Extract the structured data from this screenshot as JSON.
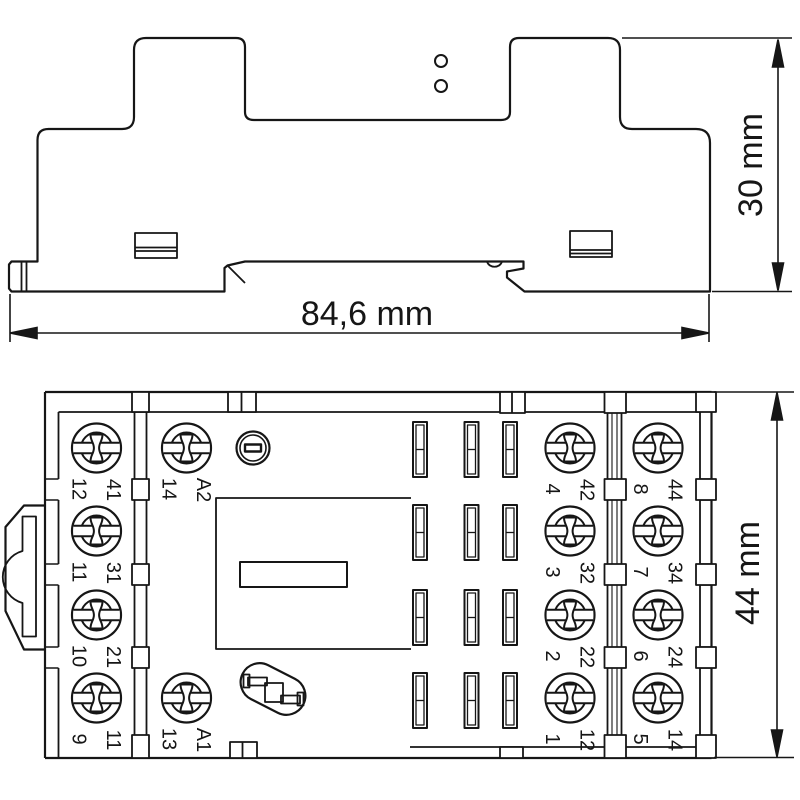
{
  "drawing": {
    "kind": "relay-socket-dimensional-drawing",
    "views": {
      "side_view": "side-profile-with-din-rail-foot",
      "top_view": "terminal-layout-top-view"
    }
  },
  "dimensions": {
    "width": "84,6 mm",
    "height": "30 mm",
    "depth": "44 mm"
  },
  "terminals": {
    "columns": [
      {
        "pairs": [
          [
            "12",
            "41"
          ],
          [
            "11",
            "31"
          ],
          [
            "10",
            "21"
          ],
          [
            "9",
            "11"
          ]
        ]
      },
      {
        "pairs": [
          [
            "14",
            "A2"
          ],
          null,
          null,
          [
            "13",
            "A1"
          ]
        ]
      },
      {
        "pairs": [
          [
            "4",
            "42"
          ],
          [
            "3",
            "32"
          ],
          [
            "2",
            "22"
          ],
          [
            "1",
            "12"
          ]
        ]
      },
      {
        "pairs": [
          [
            "8",
            "44"
          ],
          [
            "7",
            "34"
          ],
          [
            "6",
            "24"
          ],
          [
            "5",
            "14"
          ]
        ]
      }
    ]
  },
  "colors": {
    "line": "#161616",
    "background": "#ffffff"
  }
}
